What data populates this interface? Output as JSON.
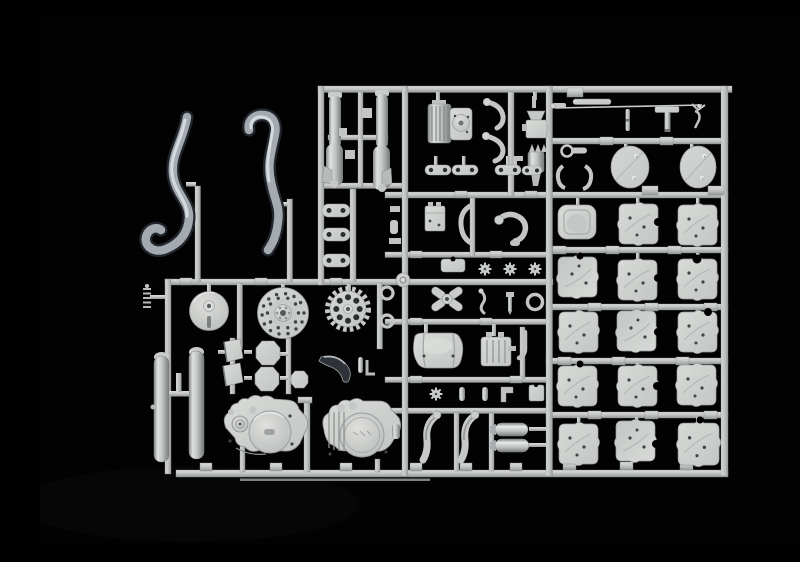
{
  "scene": {
    "description": "Product photograph of an unassembled plastic model-kit sprue: light grey polystyrene motorcycle parts (exhaust pipes, front forks, engine crankcase halves, brake disc, sprocket, fenders, cover panels) attached to a rectangular runner frame, shot on a black background",
    "background_color": "#020202",
    "plastic_base_color": "#c7cac8",
    "plastic_highlight_color": "#e6e8e6",
    "plastic_shadow_color": "#7b807e",
    "exhaust_heat_shading_color": "#22272d",
    "visible_text": ""
  },
  "sprue": {
    "panel_grid": {
      "rows": 5,
      "columns": 3
    },
    "parts": [
      {
        "id": "exhaust-pipe-left",
        "label": "Left expansion-chamber exhaust pipe"
      },
      {
        "id": "exhaust-pipe-right",
        "label": "Right expansion-chamber exhaust pipe"
      },
      {
        "id": "front-fork-leg-left",
        "label": "Front fork leg, left"
      },
      {
        "id": "front-fork-leg-right",
        "label": "Front fork leg, right"
      },
      {
        "id": "cylinder-block",
        "label": "Finned cylinder block"
      },
      {
        "id": "cylinder-head",
        "label": "Cylinder head with round cover"
      },
      {
        "id": "kickstart-levers",
        "label": "Kickstart / gear levers"
      },
      {
        "id": "carburetor-assembly",
        "label": "Carburetor and steering-stem stack"
      },
      {
        "id": "engine-mount-links",
        "label": "Dog-bone engine mount links"
      },
      {
        "id": "brake-rod-assembly",
        "label": "Long brake rod, stand and small fittings"
      },
      {
        "id": "number-plate-left",
        "label": "Oval number-plate, left"
      },
      {
        "id": "number-plate-right",
        "label": "Oval number-plate, right"
      },
      {
        "id": "seat-pad",
        "label": "Rectangular seat pad"
      },
      {
        "id": "cover-panel-grid",
        "label": "Grid of 14 rounded crankcase / hub cover panels"
      },
      {
        "id": "fork-brace-plates",
        "label": "Three drilled brace plates on ladder runner"
      },
      {
        "id": "coil-spring",
        "label": "Small coil spring"
      },
      {
        "id": "brake-drum",
        "label": "Front brake drum"
      },
      {
        "id": "brake-disc",
        "label": "Drilled brake disc"
      },
      {
        "id": "rear-sprocket",
        "label": "Rear drive sprocket"
      },
      {
        "id": "o-ring-seals",
        "label": "Two O-ring seals"
      },
      {
        "id": "mud-flaps",
        "label": "Two rubber mud flaps"
      },
      {
        "id": "foot-pads",
        "label": "Octagonal foot pads"
      },
      {
        "id": "chain-guard",
        "label": "Dark curved chain guard blade"
      },
      {
        "id": "pivot-pin-set",
        "label": "Pivot pin and L-bracket"
      },
      {
        "id": "fork-slider-left",
        "label": "Fork slider tube, left"
      },
      {
        "id": "fork-slider-right",
        "label": "Fork slider tube, right"
      },
      {
        "id": "slider-link",
        "label": "Slider connecting link"
      },
      {
        "id": "engine-crankcase-left",
        "label": "Engine crankcase half, left"
      },
      {
        "id": "engine-crankcase-right",
        "label": "Engine crankcase half with embossed clutch cover, right"
      },
      {
        "id": "battery",
        "label": "Battery box with terminals"
      },
      {
        "id": "clamp-bracket",
        "label": "C-shaped clamp bracket"
      },
      {
        "id": "intake-arm",
        "label": "Curved intake arm with socket"
      },
      {
        "id": "flat-plate",
        "label": "Small flat plate"
      },
      {
        "id": "chain-tensioner-wheels",
        "label": "Star tensioner wheels"
      },
      {
        "id": "hub-knob",
        "label": "Round hub knob"
      },
      {
        "id": "footpeg-bracket",
        "label": "Cross-shaped footpeg bracket"
      },
      {
        "id": "hand-lever",
        "label": "Small hand lever"
      },
      {
        "id": "axle-bolt",
        "label": "Axle bolt"
      },
      {
        "id": "washer-ring",
        "label": "Washer ring"
      },
      {
        "id": "fuel-tank",
        "label": "Fuel tank / airbox shell"
      },
      {
        "id": "finned-block",
        "label": "Small finned block"
      },
      {
        "id": "elbow-pipe",
        "label": "Elbow pipe"
      },
      {
        "id": "small-fittings-row",
        "label": "Row of small fittings"
      },
      {
        "id": "front-fender-halves",
        "label": "Curved front fender halves"
      },
      {
        "id": "silencer-mufflers",
        "label": "Two cylindrical silencer mufflers"
      },
      {
        "id": "runner-frame",
        "label": "Rectangular sprue runner frame with gate tabs"
      }
    ]
  }
}
